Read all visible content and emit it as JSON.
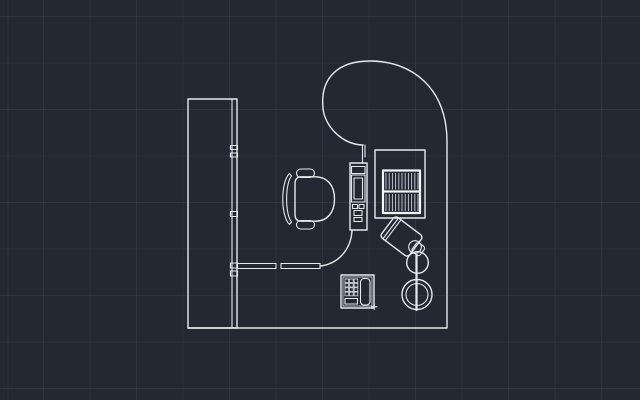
{
  "viewport": {
    "type": "cad-model-space-plan-view",
    "description": "2D CAD plan view of an office workstation: curved P-shaped desk top with return panel, modesty panels, keyboard tray with keyboard, monitor/CPU box with vent hatching, articulated task lamp, telephone and a swivel task chair on a dark gridded model space."
  },
  "colors": {
    "background": "#232933",
    "line": "#e6e9ec",
    "line-bright": "#f3f5f7",
    "line-dim": "#c7cdd5",
    "grid": "rgba(175,195,225,0.07)"
  },
  "objects": [
    {
      "name": "desk-return-panel"
    },
    {
      "name": "curved-desk-top"
    },
    {
      "name": "modesty-panel-left"
    },
    {
      "name": "modesty-panel-right"
    },
    {
      "name": "keyboard-tray"
    },
    {
      "name": "keyboard"
    },
    {
      "name": "monitor-box"
    },
    {
      "name": "task-lamp"
    },
    {
      "name": "telephone"
    },
    {
      "name": "office-chair"
    }
  ]
}
